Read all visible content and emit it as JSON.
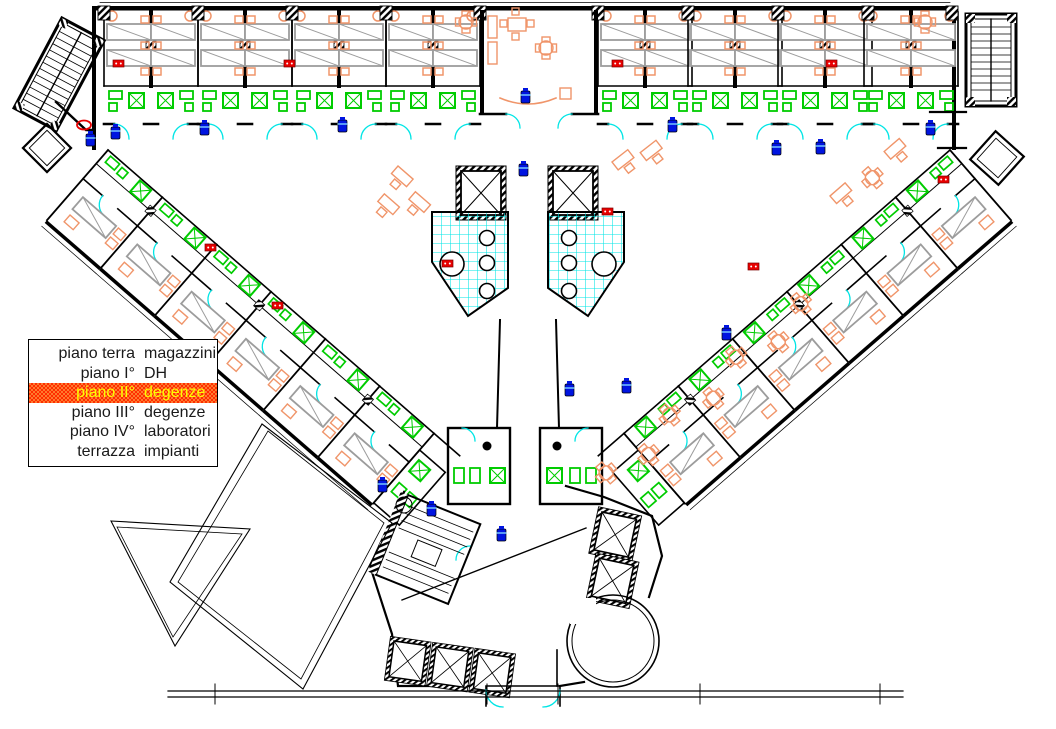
{
  "legend": {
    "rows": [
      {
        "floor": "piano terra",
        "use": "magazzini",
        "highlighted": false
      },
      {
        "floor": "piano I°",
        "use": "DH",
        "highlighted": false
      },
      {
        "floor": "piano II°",
        "use": "degenze",
        "highlighted": true
      },
      {
        "floor": "piano III°",
        "use": "degenze",
        "highlighted": false
      },
      {
        "floor": "piano IV°",
        "use": "laboratori",
        "highlighted": false
      },
      {
        "floor": "terrazza",
        "use": "impianti",
        "highlighted": false
      }
    ],
    "highlight_bg": "#ff2e00",
    "highlight_fg": "#ffff00"
  },
  "palette": {
    "paper": "#ffffff",
    "walls": "#000000",
    "beds": "#9c9c9c",
    "furniture": "#f0956a",
    "sanitary": "#00cc00",
    "door_arcs": "#00e5e5",
    "courtyard_grid": "#00e5e5",
    "fire_extinguisher": "#0014e0",
    "fire_alarm": "#e80000"
  },
  "icons": [
    {
      "name": "fire-extinguisher-icon",
      "color": "#0014e0"
    },
    {
      "name": "fire-alarm-icon",
      "color": "#e80000"
    },
    {
      "name": "hose-reel-icon",
      "color": "#e80000"
    },
    {
      "name": "door-swing-arc",
      "color": "#00e5e5"
    }
  ]
}
